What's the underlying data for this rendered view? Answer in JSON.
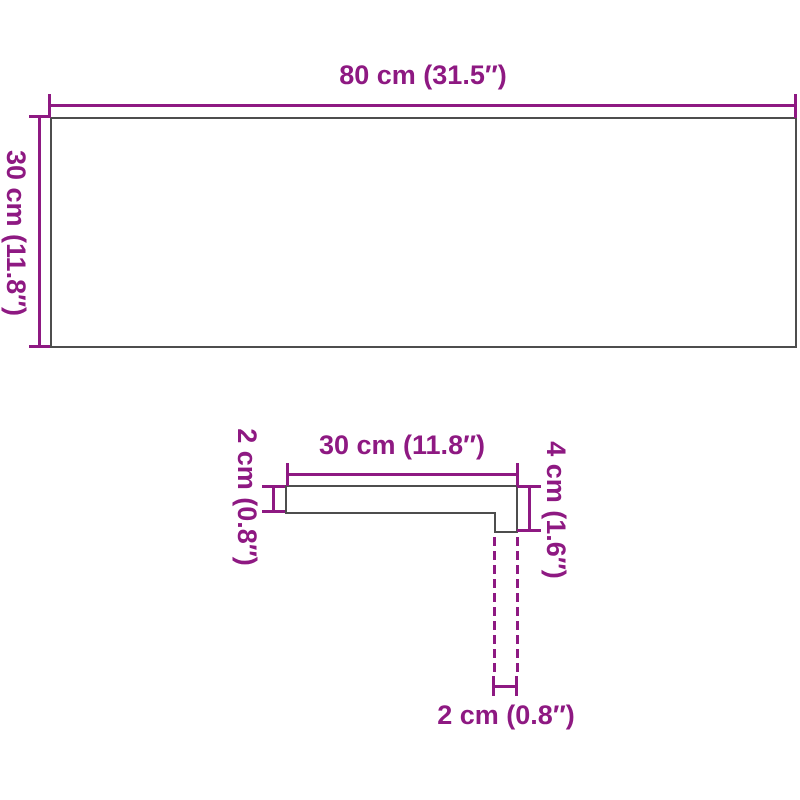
{
  "colors": {
    "accent": "#8E1982",
    "outline": "#4D4D4D",
    "background": "#FFFFFF"
  },
  "top_view": {
    "width_label": "80 cm (31.5″)",
    "height_label": "30 cm (11.8″)"
  },
  "profile_view": {
    "depth_label": "30 cm (11.8″)",
    "thickness_label": "2 cm (0.8″)",
    "front_edge_label": "4 cm (1.6″)",
    "nose_width_label": "2 cm (0.8″)"
  }
}
